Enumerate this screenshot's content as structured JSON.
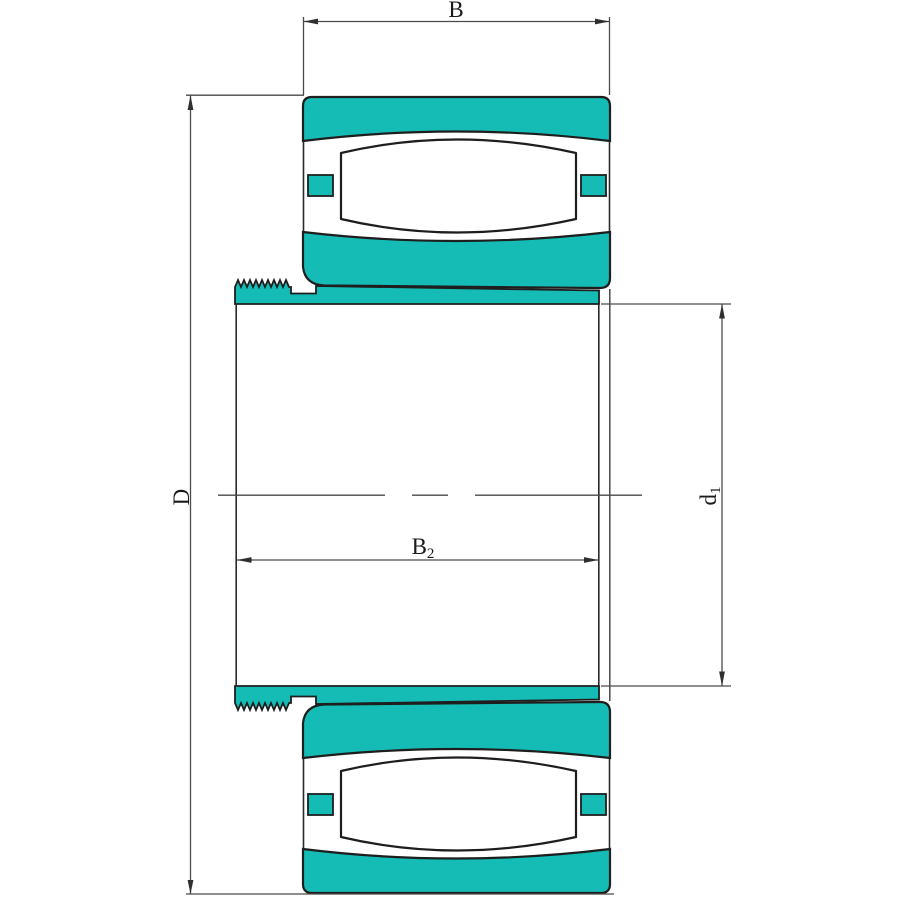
{
  "dimensions": {
    "b": {
      "label": "B"
    },
    "d": {
      "label": "D"
    },
    "b2": {
      "base": "B",
      "sub": "2"
    },
    "d1": {
      "base": "d",
      "sub": "1"
    }
  },
  "colors": {
    "ring_fill": "#15bcb5",
    "outline": "#1e1e1e",
    "dimension_line": "#4a4a4a"
  }
}
